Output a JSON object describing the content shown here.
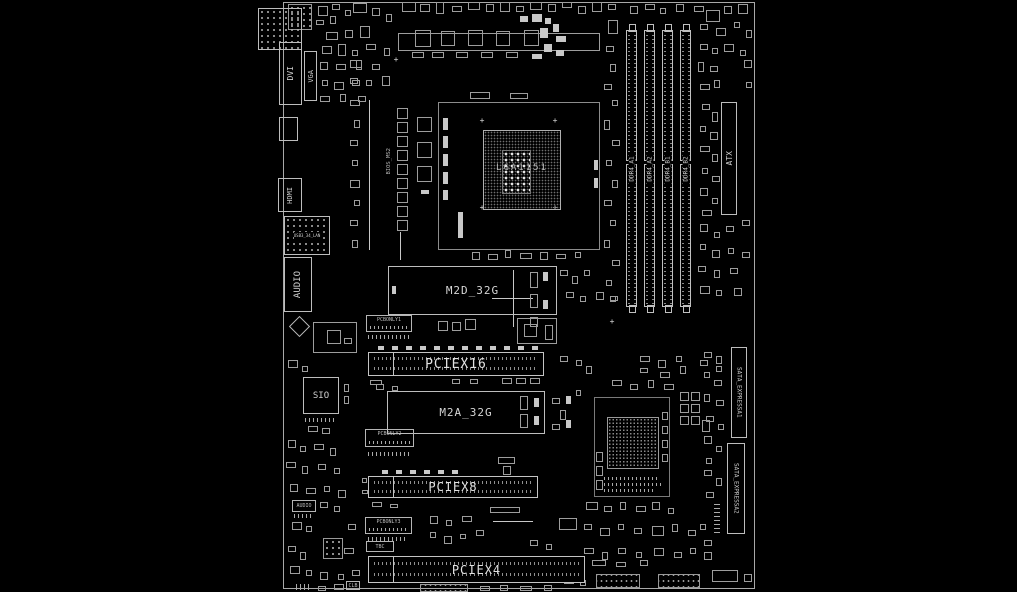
{
  "diagram": {
    "kind": "motherboard placement / boardview diagram",
    "colors": {
      "background": "#000000",
      "line": "#c8c8c8",
      "text": "#e0e0e0"
    }
  },
  "rear_io": {
    "dvi": "DVI",
    "vga": "VGA",
    "hdmi": "HDMI",
    "audio": "AUDIO",
    "lan_chip": "USB3_34_LAN"
  },
  "cpu": {
    "socket_label": "LGA1151"
  },
  "memory": {
    "slots": [
      "DDR4_A1",
      "DDR4_A2",
      "DDR4_B1",
      "DDR4_B2"
    ]
  },
  "power": {
    "atx": "ATX"
  },
  "storage": {
    "m2_top": "M2D_32G",
    "m2_bottom": "M2A_32G",
    "sata_express_1": "SATA_EXPRESSA1",
    "sata_express_2": "SATA_EXPRESSA2"
  },
  "expansion": {
    "pciex16": "PCIEX16",
    "pciex8": "PCIEX8",
    "pciex4": "PCIEX4"
  },
  "chips": {
    "sio": "SIO",
    "bios": "BIOS_MS2"
  },
  "headers": {
    "pcbonly1": "PCBONLY1",
    "pcbonly2": "PCBONLY2",
    "pcbonly3": "PCBONLY3",
    "tbc": "TBC",
    "clb": "CLB",
    "front_audio": "AUDIO"
  }
}
